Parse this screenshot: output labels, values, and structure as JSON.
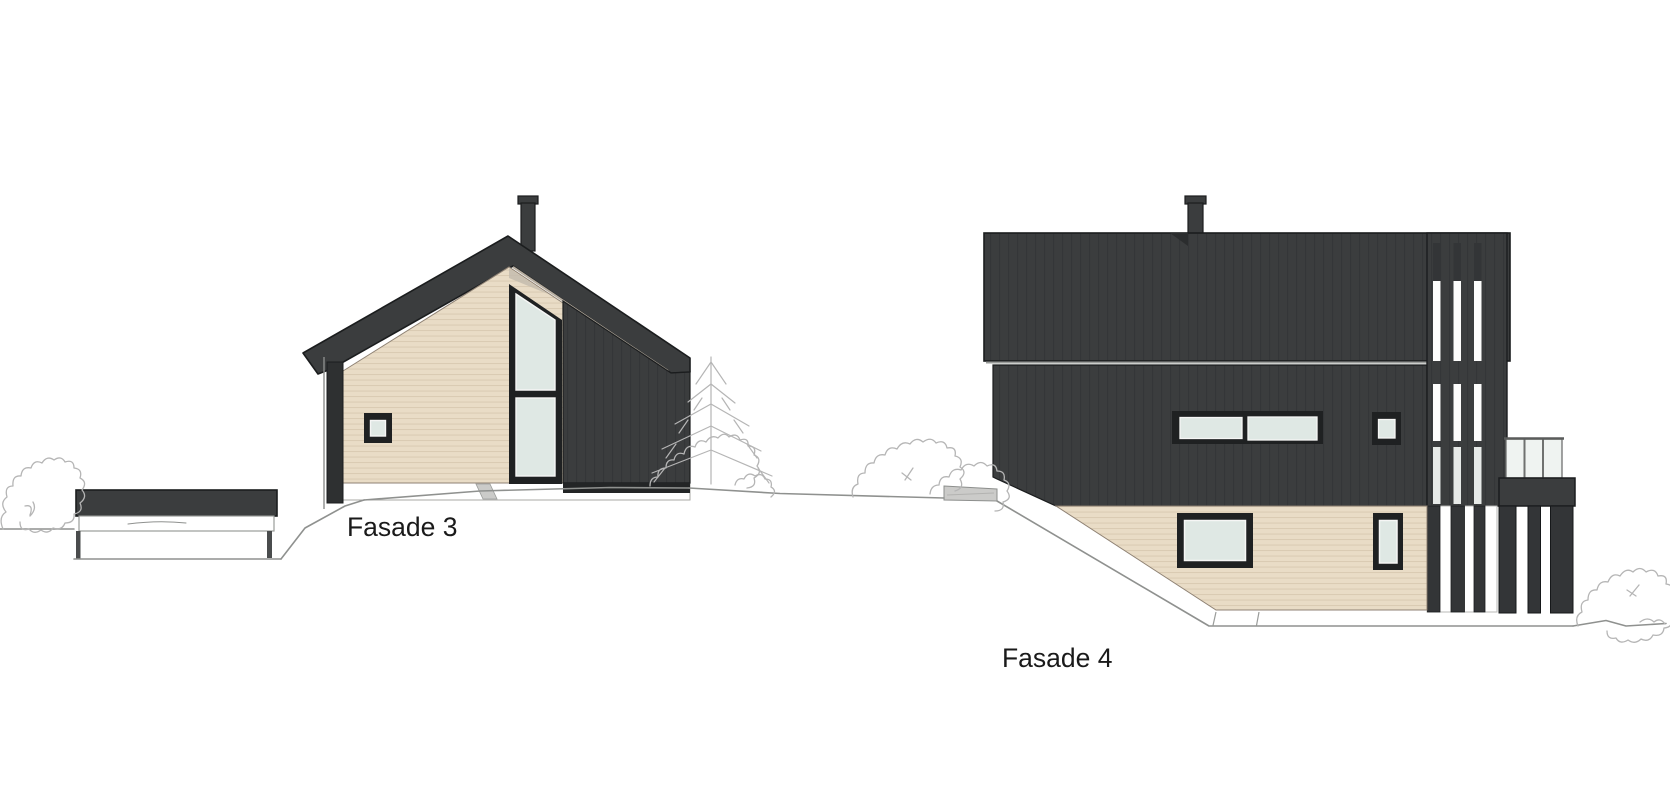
{
  "document": {
    "kind": "architectural-facade-elevation-drawing",
    "background": "#ffffff"
  },
  "elevations": [
    {
      "id": "fasade-3",
      "label": "Fasade 3"
    },
    {
      "id": "fasade-4",
      "label": "Fasade 4"
    }
  ],
  "colors": {
    "background": "#ffffff",
    "cladding_dark": "#3b3d3e",
    "cladding_dark_line": "#333537",
    "outline_dark": "#1b1d1e",
    "siding_beige": "#e9dcc6",
    "siding_beige_line": "#d9cab2",
    "window_frame": "#1f2122",
    "window_glass": "#dfe8e4",
    "glass_railing": "#eff3f1",
    "foundation_white": "#ffffff",
    "concrete_gray": "#cbcbc9",
    "terrain_line": "#8f918f",
    "sketch_line": "#b5b5b5",
    "label_text": "#1a1a1a"
  }
}
